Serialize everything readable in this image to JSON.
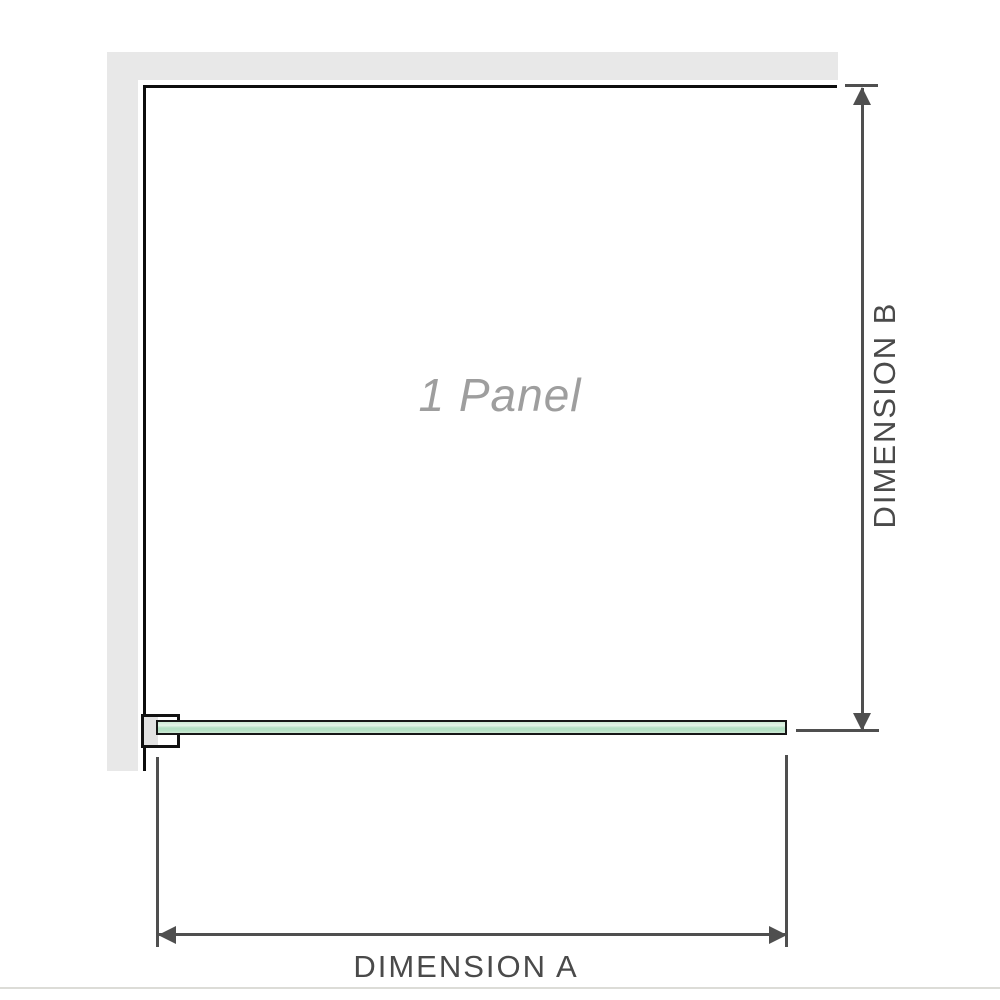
{
  "diagram": {
    "panel_label": "1 Panel",
    "dimension_a_label": "DIMENSION A",
    "dimension_b_label": "DIMENSION B"
  },
  "colors": {
    "background": "#ffffff",
    "wall_fill": "#e8e8e8",
    "frame_outline": "#0d0d0d",
    "dimension_lines": "#4f4f4f",
    "dimension_text": "#4a4a4a",
    "panel_label_text": "#9e9e9e",
    "glass_fill": "#b7e1c5",
    "glass_highlight": "#e4f3e7",
    "glass_border": "#161616",
    "bracket_outline": "#111111",
    "bracket_pad_fill": "#e2e2e2"
  }
}
